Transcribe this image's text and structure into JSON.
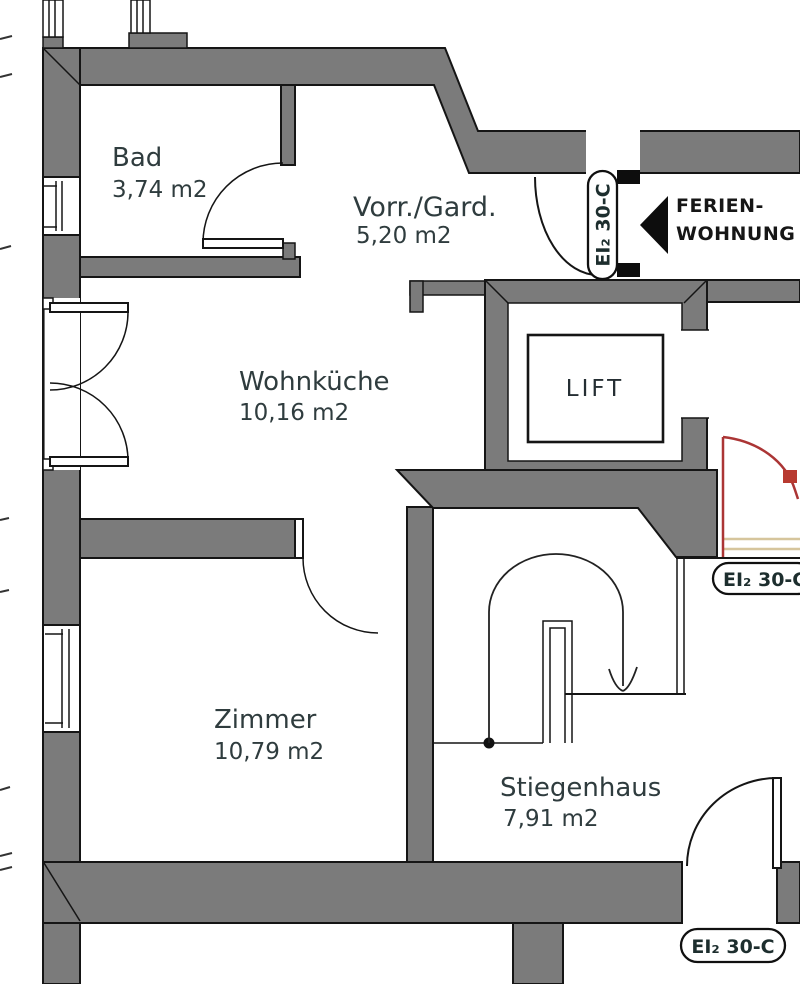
{
  "document": {
    "type": "architectural floor plan",
    "language": "de"
  },
  "rooms": [
    {
      "name": "Bad",
      "area": "3,74 m2"
    },
    {
      "name": "Vorr./Gard.",
      "area": "5,20 m2"
    },
    {
      "name": "Wohnküche",
      "area": "10,16 m2"
    },
    {
      "name": "Zimmer",
      "area": "10,79 m2"
    },
    {
      "name": "Stiegenhaus",
      "area": "7,91 m2"
    },
    {
      "name": "LIFT"
    }
  ],
  "annotations": {
    "unit_label": {
      "line1": "FERIEN-",
      "line2": "WOHNUNG"
    },
    "fire_door_labels": [
      {
        "text": "EI₂ 30-C",
        "location": "entrance-door-vertical"
      },
      {
        "text": "EI₂ 30-C",
        "location": "corridor-right-edge"
      },
      {
        "text": "EI₂ 30-C",
        "location": "stairwell-bottom-door"
      }
    ]
  },
  "colors": {
    "background": "#ffffff",
    "wall_fill": "#7b7b7b",
    "wall_outline": "#151515",
    "text": "#2f3c3e",
    "fire_door_red": "#ab3535",
    "threshold_tan": "#d6c59c"
  }
}
